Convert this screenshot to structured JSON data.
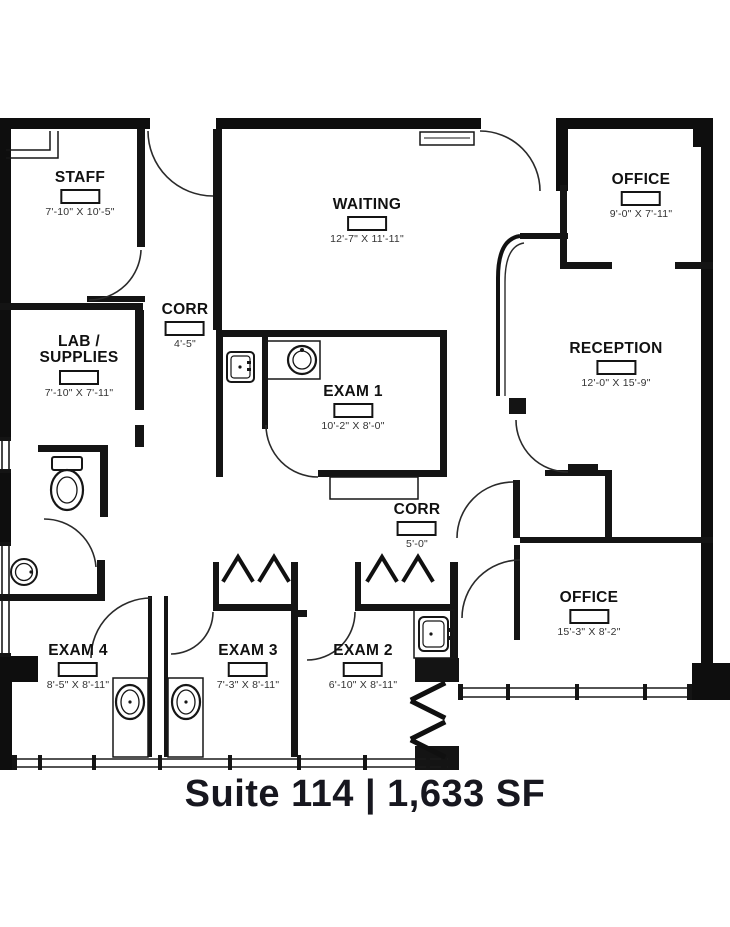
{
  "title": "Suite 114 | 1,633 SF",
  "rooms": [
    {
      "id": "staff",
      "name": "STAFF",
      "dims": "7'-10\" X 10'-5\""
    },
    {
      "id": "corr-upper",
      "name": "CORR",
      "dims": "4'-5\""
    },
    {
      "id": "lab-supplies",
      "name": "LAB / SUPPLIES",
      "dims": "7'-10\" X 7'-11\""
    },
    {
      "id": "waiting",
      "name": "WAITING",
      "dims": "12'-7\" X 11'-11\""
    },
    {
      "id": "office-upper",
      "name": "OFFICE",
      "dims": "9'-0\" X 7'-11\""
    },
    {
      "id": "exam-1",
      "name": "EXAM 1",
      "dims": "10'-2\" X 8'-0\""
    },
    {
      "id": "reception",
      "name": "RECEPTION",
      "dims": "12'-0\" X 15'-9\""
    },
    {
      "id": "corr-lower",
      "name": "CORR",
      "dims": "5'-0\""
    },
    {
      "id": "office-lower",
      "name": "OFFICE",
      "dims": "15'-3\" X 8'-2\""
    },
    {
      "id": "exam-4",
      "name": "EXAM 4",
      "dims": "8'-5\" X 8'-11\""
    },
    {
      "id": "exam-3",
      "name": "EXAM 3",
      "dims": "7'-3\" X 8'-11\""
    },
    {
      "id": "exam-2",
      "name": "EXAM 2",
      "dims": "6'-10\" X 8'-11\""
    }
  ],
  "colors": {
    "wall": "#0e0e0e",
    "line": "#1a1a1a",
    "text": "#111111",
    "dims_text": "#333333",
    "background": "#ffffff"
  }
}
